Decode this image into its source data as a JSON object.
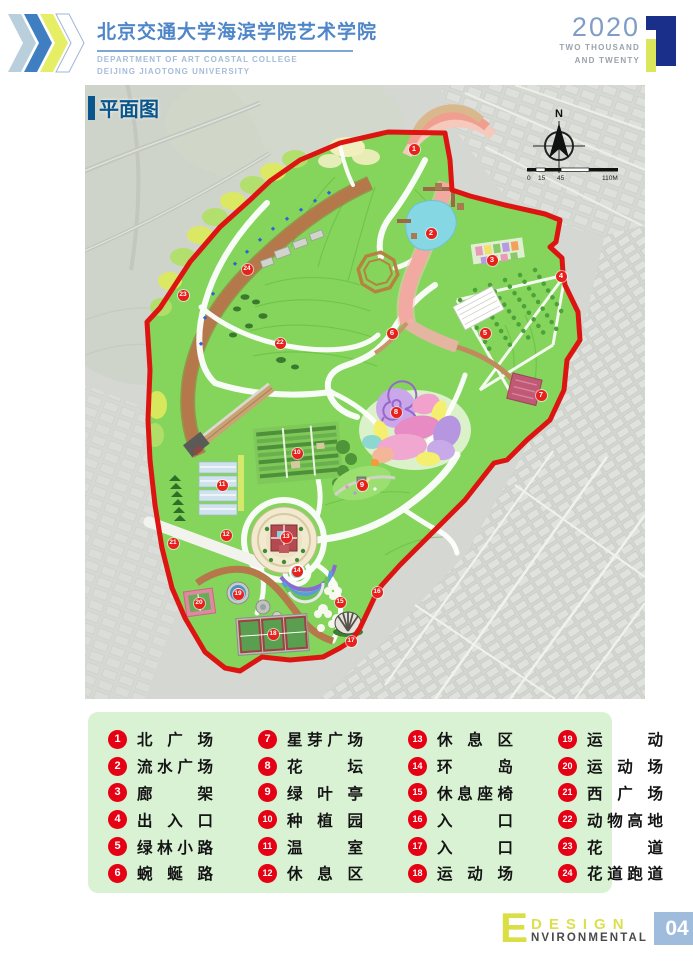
{
  "header": {
    "title": "北京交通大学海滨学院艺术学院",
    "subtitle1": "DEPARTMENT OF ART COASTAL COLLEGE",
    "subtitle2": "DEIJING JIAOTONG UNIVERSITY",
    "year": "2020",
    "year_words1": "TWO THOUSAND",
    "year_words2": "AND TWENTY"
  },
  "map": {
    "title": "平面图",
    "compass_label": "N",
    "scale_labels": [
      "0",
      "15",
      "45",
      "110M"
    ],
    "markers": [
      {
        "n": "1",
        "x": 329,
        "y": 64
      },
      {
        "n": "2",
        "x": 346,
        "y": 148
      },
      {
        "n": "3",
        "x": 407,
        "y": 175
      },
      {
        "n": "4",
        "x": 476,
        "y": 191
      },
      {
        "n": "5",
        "x": 400,
        "y": 248
      },
      {
        "n": "6",
        "x": 307,
        "y": 248
      },
      {
        "n": "7",
        "x": 456,
        "y": 310
      },
      {
        "n": "8",
        "x": 311,
        "y": 327
      },
      {
        "n": "9",
        "x": 277,
        "y": 400
      },
      {
        "n": "10",
        "x": 212,
        "y": 368
      },
      {
        "n": "11",
        "x": 137,
        "y": 400
      },
      {
        "n": "12",
        "x": 141,
        "y": 450
      },
      {
        "n": "13",
        "x": 201,
        "y": 452
      },
      {
        "n": "14",
        "x": 212,
        "y": 486
      },
      {
        "n": "15",
        "x": 255,
        "y": 517
      },
      {
        "n": "16",
        "x": 292,
        "y": 507
      },
      {
        "n": "17",
        "x": 266,
        "y": 556
      },
      {
        "n": "18",
        "x": 188,
        "y": 549
      },
      {
        "n": "19",
        "x": 153,
        "y": 509
      },
      {
        "n": "20",
        "x": 114,
        "y": 518
      },
      {
        "n": "21",
        "x": 88,
        "y": 458
      },
      {
        "n": "22",
        "x": 195,
        "y": 258
      },
      {
        "n": "23",
        "x": 98,
        "y": 210
      },
      {
        "n": "24",
        "x": 162,
        "y": 184
      }
    ]
  },
  "legend": {
    "items": [
      {
        "num": "1",
        "label": "北广场"
      },
      {
        "num": "2",
        "label": "流水广场"
      },
      {
        "num": "3",
        "label": "廊架"
      },
      {
        "num": "4",
        "label": "出入口"
      },
      {
        "num": "5",
        "label": "绿林小路"
      },
      {
        "num": "6",
        "label": "蜿蜒路"
      },
      {
        "num": "7",
        "label": "星芽广场"
      },
      {
        "num": "8",
        "label": "花坛"
      },
      {
        "num": "9",
        "label": "绿叶亭"
      },
      {
        "num": "10",
        "label": "种植园"
      },
      {
        "num": "11",
        "label": "温室"
      },
      {
        "num": "12",
        "label": "休息区"
      },
      {
        "num": "13",
        "label": "休息区"
      },
      {
        "num": "14",
        "label": "环岛"
      },
      {
        "num": "15",
        "label": "休息座椅"
      },
      {
        "num": "16",
        "label": "入口"
      },
      {
        "num": "17",
        "label": "入口"
      },
      {
        "num": "18",
        "label": "运动场"
      },
      {
        "num": "19",
        "label": "运动"
      },
      {
        "num": "20",
        "label": "运动场"
      },
      {
        "num": "21",
        "label": "西广场"
      },
      {
        "num": "22",
        "label": "动物高地"
      },
      {
        "num": "23",
        "label": "花道"
      },
      {
        "num": "24",
        "label": "花道跑道"
      }
    ]
  },
  "footer": {
    "e": "E",
    "design": "DESIGN",
    "environmental": "NVIRONMENTAL",
    "page": "04"
  },
  "colors": {
    "marker_red": "#e8211d",
    "boundary_red": "#dd1512",
    "park_green": "#85d45c",
    "header_blue": "#4f86c8",
    "legend_bg": "#d9f2d4",
    "footer_yellow": "#dde04e",
    "footer_page_blue": "#9fbcdc"
  }
}
